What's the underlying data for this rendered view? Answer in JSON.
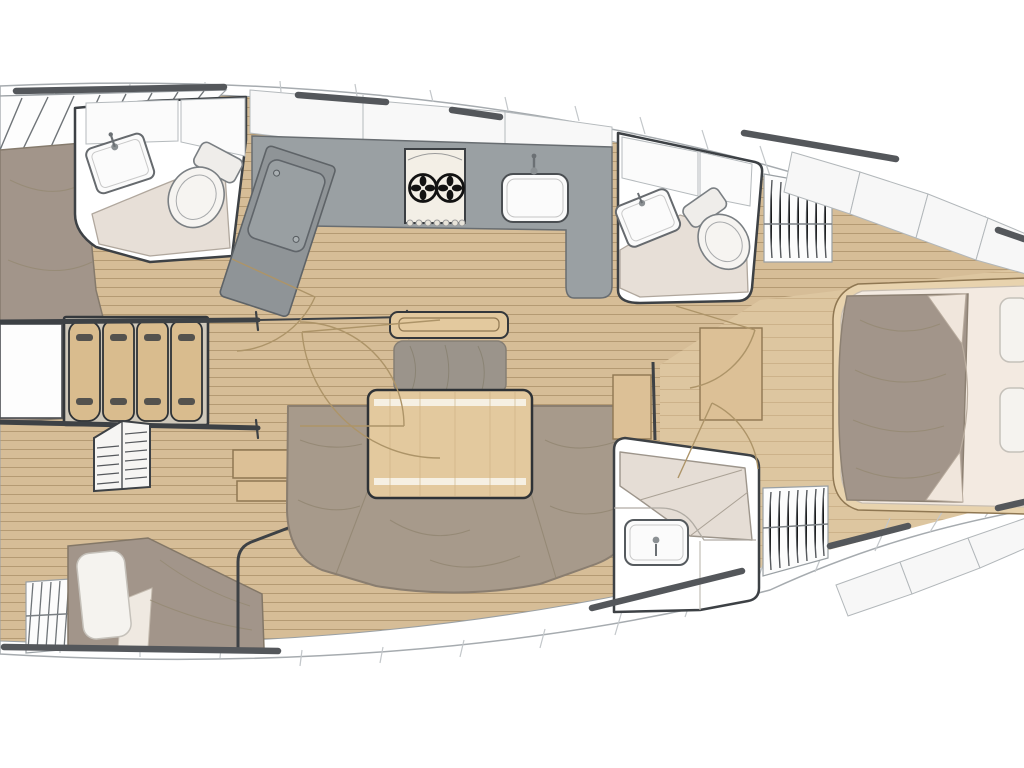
{
  "plan": {
    "subject": "sailing-yacht-interior-floor-plan",
    "orientation": "bow-right-stern-left",
    "rooms": [
      "aft-port-cabin",
      "port-head",
      "companionway",
      "galley",
      "salon",
      "forward-starboard-head",
      "aft-starboard-cabin",
      "aft-starboard-head",
      "owner-cabin-forward"
    ],
    "furniture": [
      "companionway-stairs",
      "two-burner-stove",
      "galley-sink",
      "top-load-fridge",
      "salon-table",
      "u-shaped-sofa",
      "settee-bench",
      "port-head-sink",
      "port-head-toilet",
      "starboard-head-sink",
      "starboard-head-toilet",
      "aft-head-sink",
      "hanging-lockers",
      "aft-port-bed",
      "aft-starboard-berth",
      "owner-bed",
      "owner-pillows",
      "door-swings"
    ]
  },
  "colors": {
    "hull_outline": "#a6abaf",
    "deck_white": "#ffffff",
    "caprail": "#54575b",
    "wall": "#3d4145",
    "wood_floor": "#d6bd97",
    "plank_line": "#b49a73",
    "wood_light": "#ddc6a0",
    "table_wood": "#e3c99e",
    "cabinet_wood": "#dcc096",
    "tread_wood": "#d9bc8e",
    "counter_gray": "#9aa0a3",
    "counter_dark": "#8f9497",
    "lid_gray": "#999fa2",
    "wet_room_floor": "#e7dfd7",
    "white_fixture": "#fbfbfb",
    "cushion_taupe": "#a79a8b",
    "duvet_taupe": "#a2958a",
    "mattress_cream": "#f3eae1",
    "pillow_white": "#f5f3ef",
    "berth_beige": "#e5ddd5",
    "stern_step_gray": "#c9cbcd",
    "door_arc": "#ad9468"
  }
}
